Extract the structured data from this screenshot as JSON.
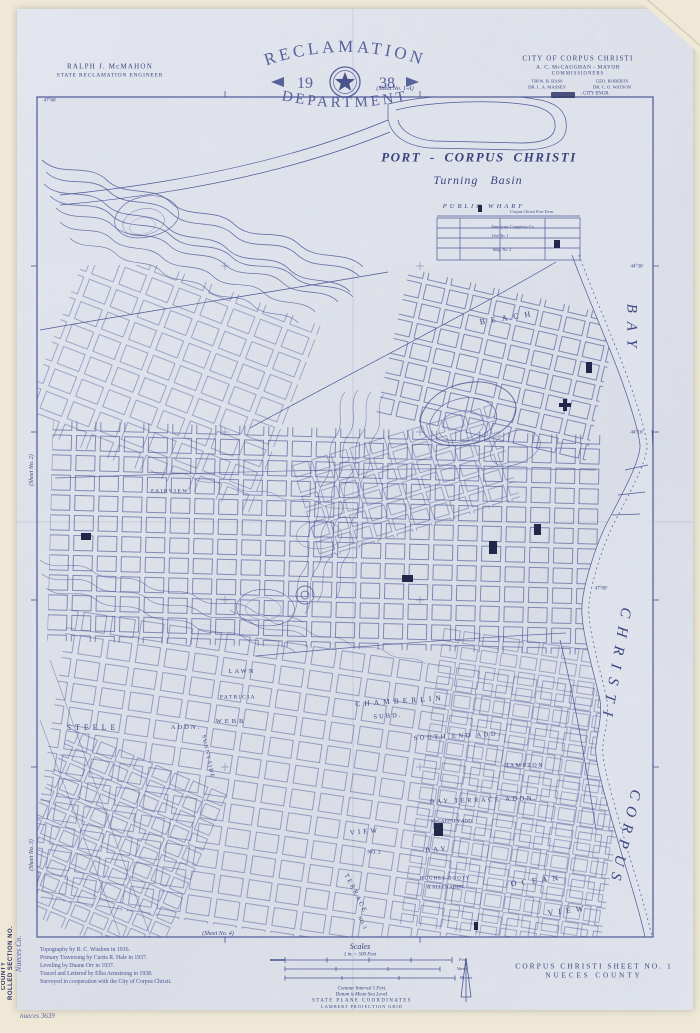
{
  "colors": {
    "ink": "#4a5494",
    "ink_dark": "#353e7a",
    "paper": "#e3e6ee",
    "backing": "#efe8d6",
    "stamp_navy": "#2e356c"
  },
  "header": {
    "engineer": {
      "name": "RALPH J. McMAHON",
      "title": "STATE RECLAMATION ENGINEER"
    },
    "reclamation_seal": {
      "arc_top": "RECLAMATION",
      "year_left": "19",
      "year_right": "38",
      "arc_bottom": "DEPARTMENT"
    },
    "city": {
      "line1": "CITY OF CORPUS CHRISTI",
      "line2": "A. C. McCAUGHAN - MAYOR",
      "line3": "COMMISSIONERS",
      "comm1": "THOS. B. BASS",
      "comm2": "GEO. ROBERTS",
      "comm3": "DR. L. A. MASSEY",
      "comm4": "DR. C. O. WATSON",
      "engr": "- CITY ENGR."
    }
  },
  "margins": {
    "top": "(Sheet No. 1-A)",
    "left_upper": "(Sheet No. 2)",
    "left_lower": "(Sheet No. 3)",
    "bottom": "(Sheet No. 4)"
  },
  "stamp": {
    "line1": "ROLLED SECTION NO.",
    "line2": "COUNTY",
    "handwriting": "Nueces Co.",
    "catalog": "nueces 3639"
  },
  "map": {
    "port": {
      "title": "PORT - CORPUS CHRISTI",
      "subtitle": "Turning Basin",
      "wharf": "PUBLIC WHARF",
      "terminal": "Corpus Christi Port Term.",
      "compress": "American Compress Co.",
      "unit1": "Unit No. 1",
      "unit2": "Bldg. No. 2"
    },
    "areas": [
      "BEACH",
      "BAY",
      "CHRISTI",
      "CORPUS",
      "CHAMBERLIN",
      "SUBD.",
      "STEELE",
      "ADDN.",
      "PATRICIA",
      "WEBB",
      "LAWN",
      "SUNNYSIDE",
      "SOUTH END ADD.",
      "HAMPTON",
      "BAY TERRACE ADDN.",
      "VIEW",
      "NO. 2",
      "BAY",
      "McCAFFNEY ADD.",
      "HUGHES BOOTY",
      "& ALLEN ADDN.",
      "OCEAN",
      "VIEW",
      "TERRACE",
      "NO. 3",
      "FAIRVIEW"
    ],
    "coords": [
      "47°06'",
      "44°36'",
      "44°16'",
      "47°00'"
    ]
  },
  "footer": {
    "credits": [
      "Topography by R. C. Wisdom in 1936.",
      "Primary Traversing by Curtis R. Hale in 1937.",
      "Leveling by Duane Orr in 1937.",
      "Traced and Lettered by Elba Armstrong in 1938.",
      "Surveyed in cooperation with the City of Corpus Christi."
    ],
    "scales": {
      "title": "Scales",
      "subtitle": "1 in. = 500 Feet",
      "units": [
        "Feet",
        "Varas",
        "Meters"
      ],
      "contour": "Contour Interval 5 Feet.",
      "datum": "Datum is Mean Sea Level.",
      "grid1": "STATE PLANE COORDINATES",
      "grid2": "LAMBERT PROJECTION GRID"
    },
    "sheet_title": {
      "line1": "CORPUS CHRISTI SHEET NO. 1",
      "line2": "NUECES COUNTY"
    }
  }
}
